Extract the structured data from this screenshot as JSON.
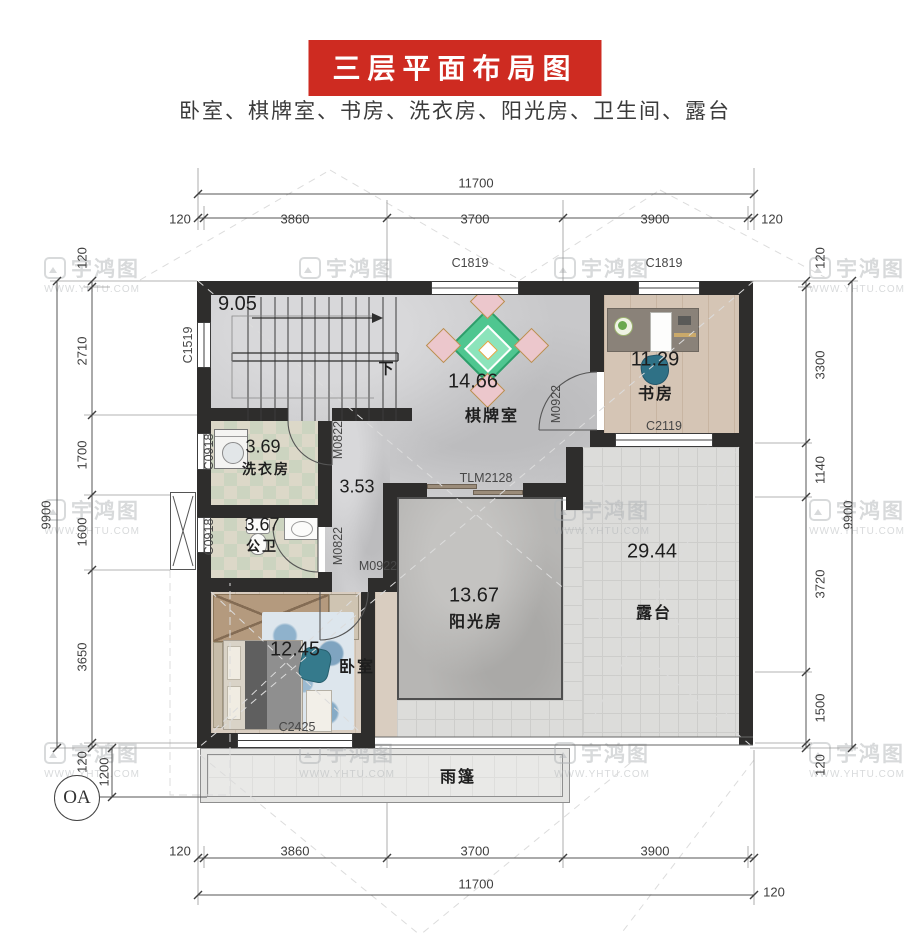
{
  "title": "三层平面布局图",
  "subtitle": "卧室、棋牌室、书房、洗衣房、阳光房、卫生间、露台",
  "watermark": {
    "name": "宇鸿图",
    "site": "WWW.YHTU.COM"
  },
  "colors": {
    "banner_red": "#ce2b21",
    "wall_black": "#2e2d2c"
  },
  "rooms": {
    "stairs": {
      "area": "9.05",
      "down_label": "下"
    },
    "chess": {
      "area": "14.66",
      "name": "棋牌室"
    },
    "study": {
      "area": "11.29",
      "name": "书房"
    },
    "laundry": {
      "area": "3.69",
      "name": "洗衣房"
    },
    "hall": {
      "area": "3.53"
    },
    "bath": {
      "area": "3.67",
      "name": "公卫"
    },
    "sunroom": {
      "area": "13.67",
      "name": "阳光房"
    },
    "terrace": {
      "area": "29.44",
      "name": "露台"
    },
    "bedroom": {
      "area": "12.45",
      "name": "卧室"
    },
    "canopy": {
      "name": "雨篷"
    }
  },
  "openings": {
    "c1819": "C1819",
    "c1519": "C1519",
    "c0918": "C0918",
    "c2119": "C2119",
    "c2425": "C2425",
    "tlm2128": "TLM2128",
    "m0822": "M0822",
    "m0922": "M0922"
  },
  "dims": {
    "top": {
      "total": "11700",
      "chain": [
        "120",
        "3860",
        "3700",
        "3900",
        "120"
      ]
    },
    "bottom": {
      "total": "11700",
      "chain": [
        "120",
        "3860",
        "3700",
        "3900"
      ],
      "right": "120"
    },
    "left": {
      "total": "9900",
      "chain": [
        "120",
        "2710",
        "1700",
        "1600",
        "3650",
        "120"
      ],
      "offset": "1200"
    },
    "right": {
      "total": "9900",
      "chain": [
        "120",
        "3300",
        "1140",
        "3720",
        "1500",
        "120"
      ]
    }
  },
  "axis": {
    "label": "OA"
  }
}
